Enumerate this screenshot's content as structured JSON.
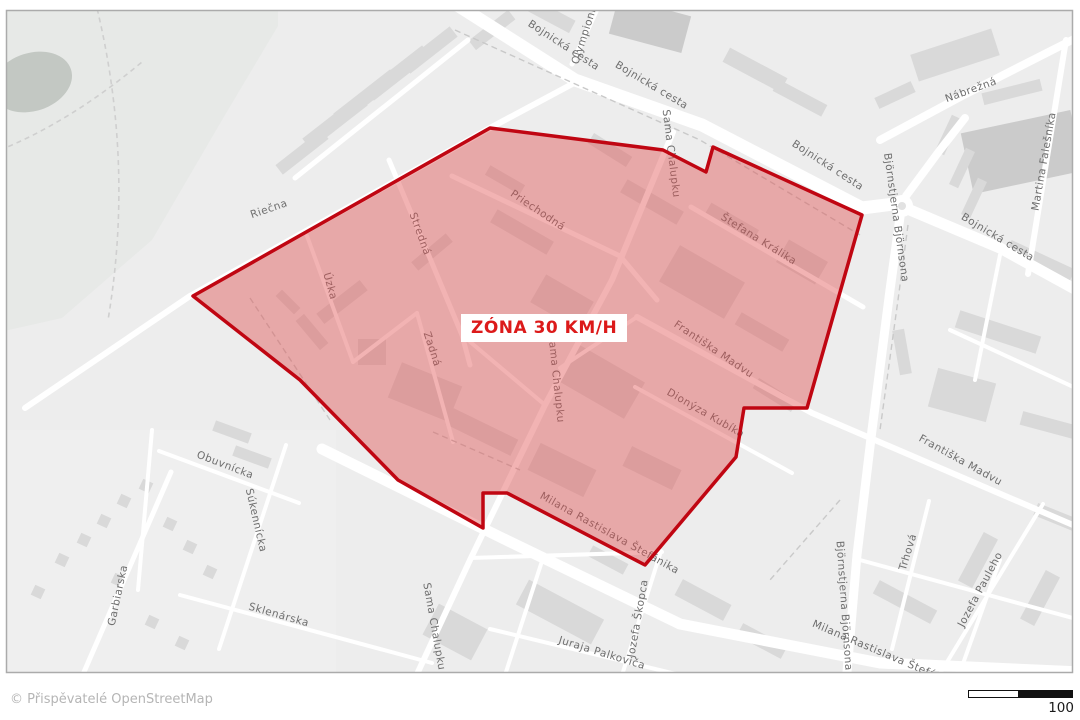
{
  "map": {
    "zone_label": "ZÓNA 30 KM/H",
    "street_labels": [
      {
        "text": "Bojnická cesta"
      },
      {
        "text": "Bojnická cesta"
      },
      {
        "text": "Bojnická cesta"
      },
      {
        "text": "Bojnická cesta"
      },
      {
        "text": "Olympionikov"
      },
      {
        "text": "Nábrežná"
      },
      {
        "text": "Martina Falešníka"
      },
      {
        "text": "Björnstjerna Björnsona"
      },
      {
        "text": "Björnstjerna Björnsona"
      },
      {
        "text": "Riečna"
      },
      {
        "text": "Úzka"
      },
      {
        "text": "Stredná"
      },
      {
        "text": "Zadná"
      },
      {
        "text": "Priechodná"
      },
      {
        "text": "Sama Chalupku"
      },
      {
        "text": "Sama Chalupku"
      },
      {
        "text": "Sama Chalupku"
      },
      {
        "text": "Štefana Králika"
      },
      {
        "text": "Františka Madvu"
      },
      {
        "text": "Františka Madvu"
      },
      {
        "text": "Dionýza Kubíka"
      },
      {
        "text": "Milana Rastislava Štefánika"
      },
      {
        "text": "Milana Rastislava Štefánika"
      },
      {
        "text": "Obuvnícka"
      },
      {
        "text": "Súkennícka"
      },
      {
        "text": "Sklenárska"
      },
      {
        "text": "Garbiarska"
      },
      {
        "text": "Trhová"
      },
      {
        "text": "Jozefa Pauleho"
      },
      {
        "text": "Jozefa Škopca"
      },
      {
        "text": "Juraja Palkoviča"
      }
    ]
  },
  "footer": {
    "attribution": "© Přispěvatelé OpenStreetMap",
    "scale_label": "100"
  },
  "colors": {
    "zone_fill": "#e14b4b",
    "zone_border": "#c00612",
    "zone_label_text": "#dc1a1a",
    "map_background": "#ededed",
    "road": "#ffffff",
    "building": "#d9d9d9",
    "street_label_text": "#6e6e6e"
  }
}
